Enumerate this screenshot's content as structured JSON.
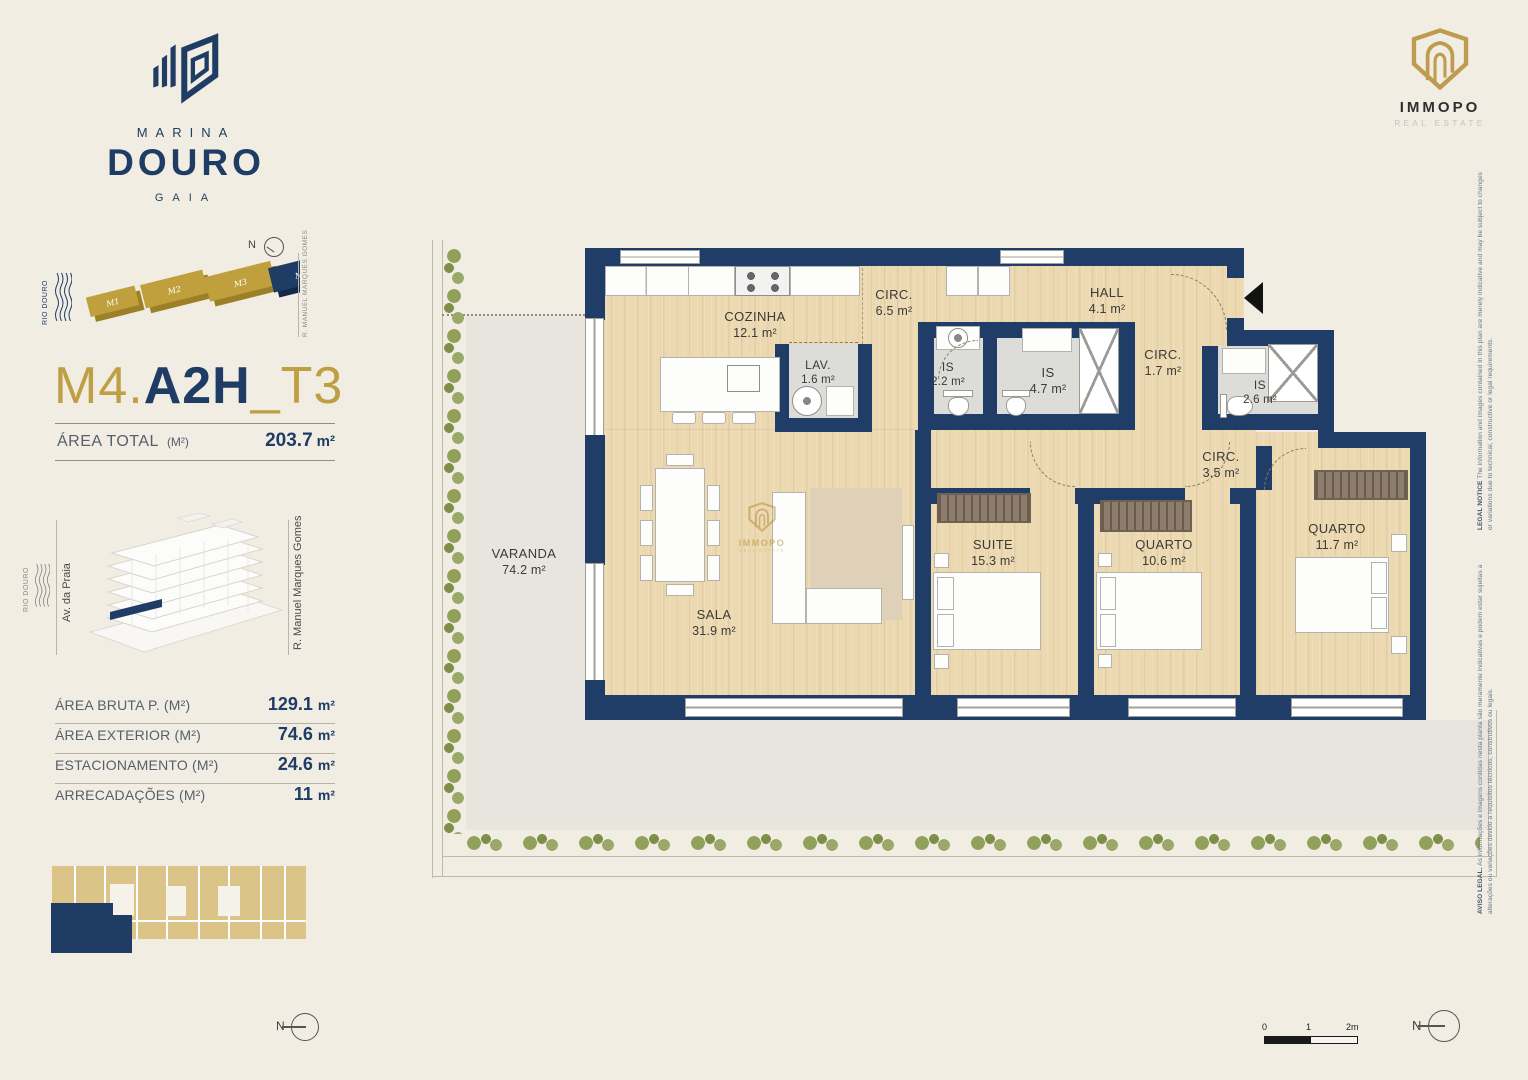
{
  "brand": {
    "name_top": "MARINA",
    "name_main": "DOURO",
    "name_sub": "GAIA"
  },
  "masterplan": {
    "blocks": [
      {
        "label": "M1",
        "color": "#BFA03D"
      },
      {
        "label": "M2",
        "color": "#BFA03D"
      },
      {
        "label": "M3",
        "color": "#BFA03D"
      },
      {
        "label": "M4",
        "color": "#1E3C64"
      }
    ],
    "highlighted_block": "M4",
    "compass": "N",
    "river_label": "RIO DOURO",
    "street_label": "R. MANUEL MARQUES GOMES"
  },
  "unit": {
    "block": "M4.",
    "code": "A2H",
    "type": "_T3"
  },
  "area_total": {
    "label": "ÁREA TOTAL",
    "unit_note": "(M²)",
    "value": "203.7",
    "unit": "m²"
  },
  "location": {
    "river_label": "RIO DOURO",
    "street_left": "Av. da Praia",
    "street_right": "R. Manuel Marques Gomes"
  },
  "areas": {
    "rows": [
      {
        "label": "ÁREA BRUTA P. (M²)",
        "value": "129.1",
        "unit": "m²"
      },
      {
        "label": "ÁREA EXTERIOR (M²)",
        "value": "74.6",
        "unit": "m²"
      },
      {
        "label": "ESTACIONAMENTO (M²)",
        "value": "24.6",
        "unit": "m²"
      },
      {
        "label": "ARRECADAÇÕES (M²)",
        "value": "11",
        "unit": "m²"
      }
    ]
  },
  "siteplan": {
    "compass": "N"
  },
  "plan": {
    "rooms": {
      "varanda": {
        "name": "VARANDA",
        "area": "74.2 m²"
      },
      "cozinha": {
        "name": "COZINHA",
        "area": "12.1 m²"
      },
      "circ65": {
        "name": "CIRC.",
        "area": "6.5 m²"
      },
      "hall": {
        "name": "HALL",
        "area": "4.1 m²"
      },
      "lav": {
        "name": "LAV.",
        "area": "1.6 m²"
      },
      "is22": {
        "name": "IS",
        "area": "2.2 m²"
      },
      "is47": {
        "name": "IS",
        "area": "4.7 m²"
      },
      "circ17": {
        "name": "CIRC.",
        "area": "1.7 m²"
      },
      "is26": {
        "name": "IS",
        "area": "2.6 m²"
      },
      "circ35": {
        "name": "CIRC.",
        "area": "3.5 m²"
      },
      "sala": {
        "name": "SALA",
        "area": "31.9 m²"
      },
      "suite": {
        "name": "SUITE",
        "area": "15.3 m²"
      },
      "quarto106": {
        "name": "QUARTO",
        "area": "10.6 m²"
      },
      "quarto117": {
        "name": "QUARTO",
        "area": "11.7 m²"
      }
    },
    "watermark": {
      "name": "IMMOPO",
      "tagline": "REAL ESTATE"
    },
    "compass": "N"
  },
  "immopo": {
    "name": "IMMOPO",
    "tagline": "REAL ESTATE"
  },
  "legal": {
    "pt_label": "AVISO LEGAL.",
    "pt_text": " As informações e imagens contidas nesta planta são meramente indicativas e podem estar sujeitas a alterações ou variações devido a requisitos técnicos, construtivos ou legais.",
    "en_label": "LEGAL NOTICE",
    "en_text": " The information and images contained in this plan are merely indicative and may be subject to changes or variations due to technical, constructive or legal requirements."
  },
  "scalebar": {
    "zero": "0",
    "one": "1",
    "two": "2m"
  },
  "compass_sw": "N",
  "compass_se": "N",
  "colors": {
    "navy": "#1E3C64",
    "gold": "#BF9F43",
    "cream": "#F1EDE3",
    "wood": "#ECD9B1",
    "terrace": "#E7E5DD",
    "hedge": "#8E9D58"
  }
}
